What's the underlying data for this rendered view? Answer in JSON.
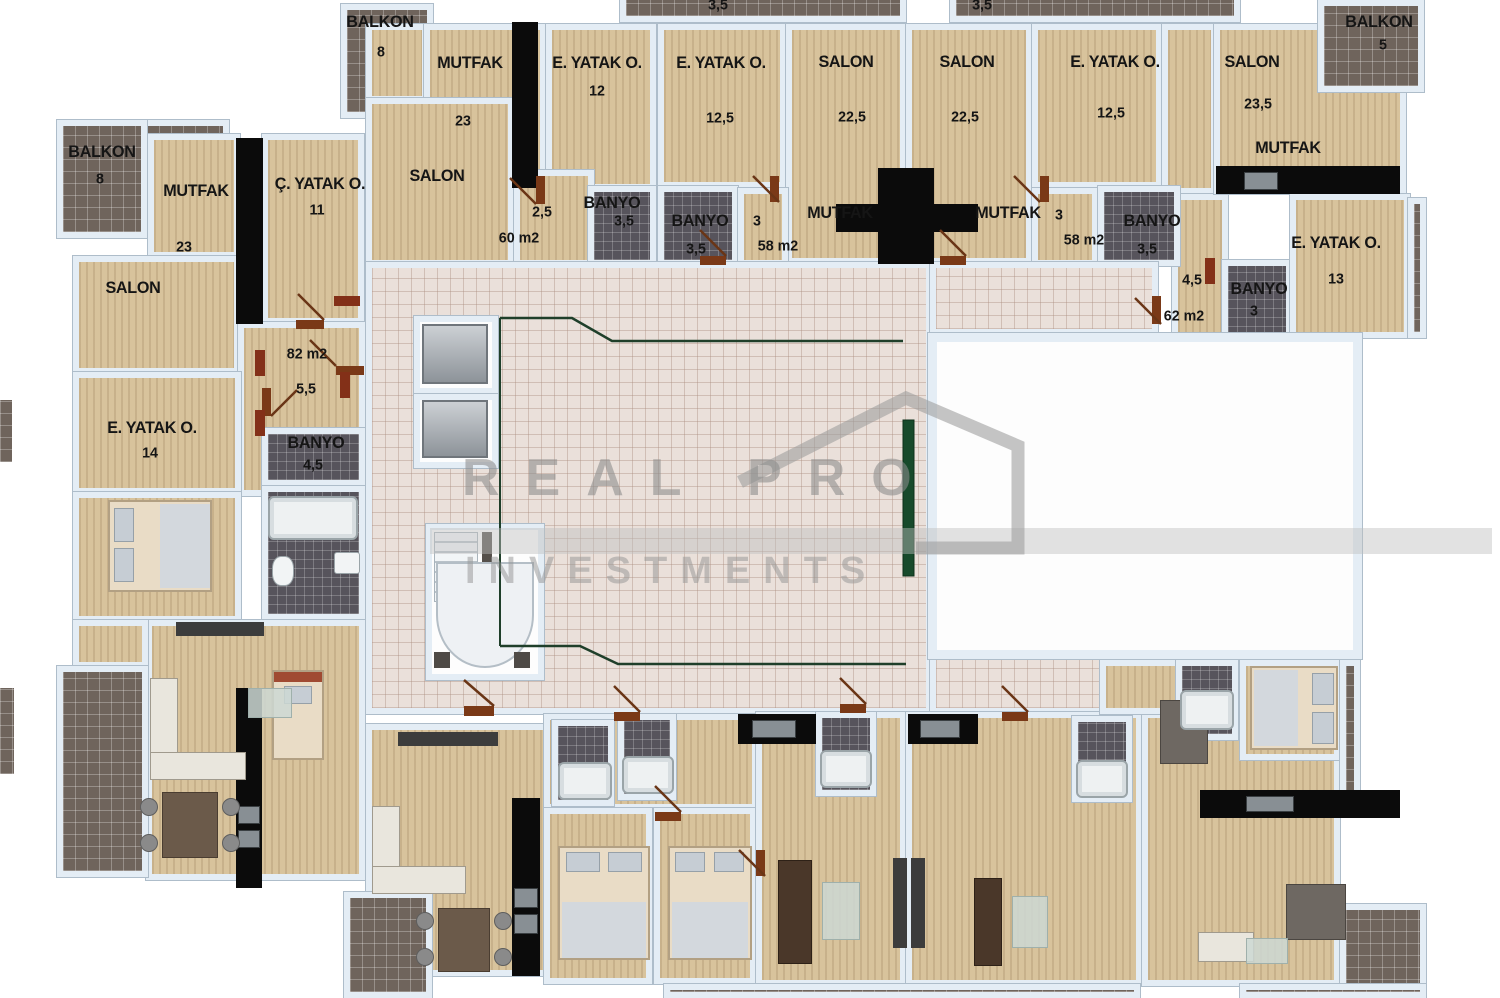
{
  "watermark": {
    "line1": "REAL PRO",
    "line2": "INVESTMENTS"
  },
  "units": {
    "u82": {
      "total_area": "82 m2",
      "hall_area": "5,5",
      "balkon_label": "BALKON",
      "balkon_area": "8",
      "mutfak_label": "MUTFAK",
      "mutfak_area": "23",
      "c_yatak_label": "Ç. YATAK O.",
      "c_yatak_area": "11",
      "salon_label": "SALON",
      "e_yatak_label": "E. YATAK O.",
      "e_yatak_area": "14",
      "banyo_label": "BANYO",
      "banyo_area": "4,5"
    },
    "u60": {
      "total_area": "60 m2",
      "hall_area": "2,5",
      "balkon_label": "BALKON",
      "balkon_area": "8",
      "mutfak_label": "MUTFAK",
      "mutfak_area": "23",
      "salon_label": "SALON",
      "e_yatak_label": "E. YATAK O.",
      "e_yatak_area": "12",
      "banyo_label": "BANYO",
      "banyo_area": "3,5"
    },
    "u58a": {
      "total_area": "58 m2",
      "hall_area": "3",
      "balkon_area": "3,5",
      "e_yatak_label": "E. YATAK O.",
      "e_yatak_area": "12,5",
      "salon_label": "SALON",
      "salon_area": "22,5",
      "mutfak_label": "MUTFAK",
      "banyo_label": "BANYO",
      "banyo_area": "3,5"
    },
    "u58b": {
      "total_area": "58 m2",
      "hall_area": "3",
      "balkon_area": "3,5",
      "salon_label": "SALON",
      "salon_area": "22,5",
      "e_yatak_label": "E. YATAK O.",
      "e_yatak_area": "12,5",
      "mutfak_label": "MUTFAK",
      "banyo_label": "BANYO",
      "banyo_area": "3,5"
    },
    "u62": {
      "total_area": "62 m2",
      "hall_area": "4,5",
      "salon_label": "SALON",
      "salon_area": "23,5",
      "mutfak_label": "MUTFAK",
      "balkon_label": "BALKON",
      "balkon_area": "5",
      "e_yatak_label": "E. YATAK O.",
      "e_yatak_area": "13",
      "banyo_label": "BANYO",
      "banyo_area": "3"
    }
  }
}
